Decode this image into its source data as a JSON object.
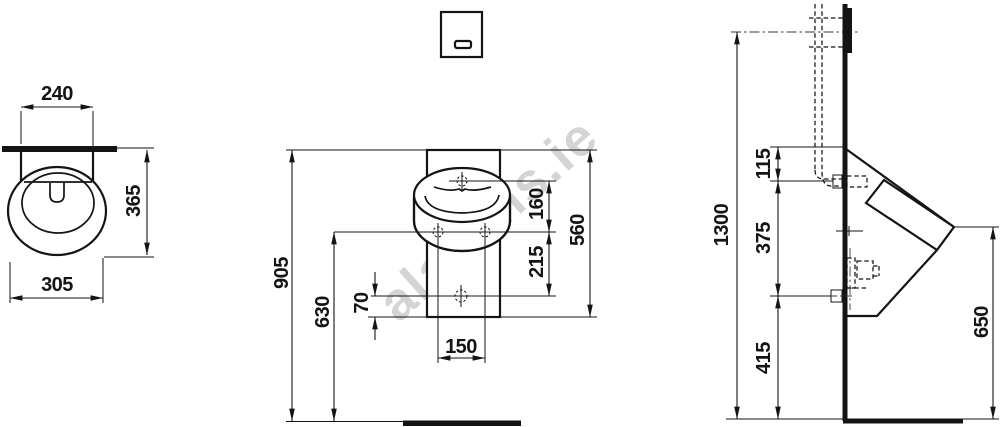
{
  "watermark": "alasens.ie",
  "views": {
    "top": {
      "dims": {
        "d240": "240",
        "d365": "365",
        "d305": "305"
      }
    },
    "front": {
      "dims": {
        "d905": "905",
        "d630": "630",
        "d70": "70",
        "d150": "150",
        "d160": "160",
        "d215": "215",
        "d560": "560"
      }
    },
    "side": {
      "dims": {
        "d1300": "1300",
        "d115": "115",
        "d375": "375",
        "d415": "415",
        "d650": "650"
      }
    }
  }
}
